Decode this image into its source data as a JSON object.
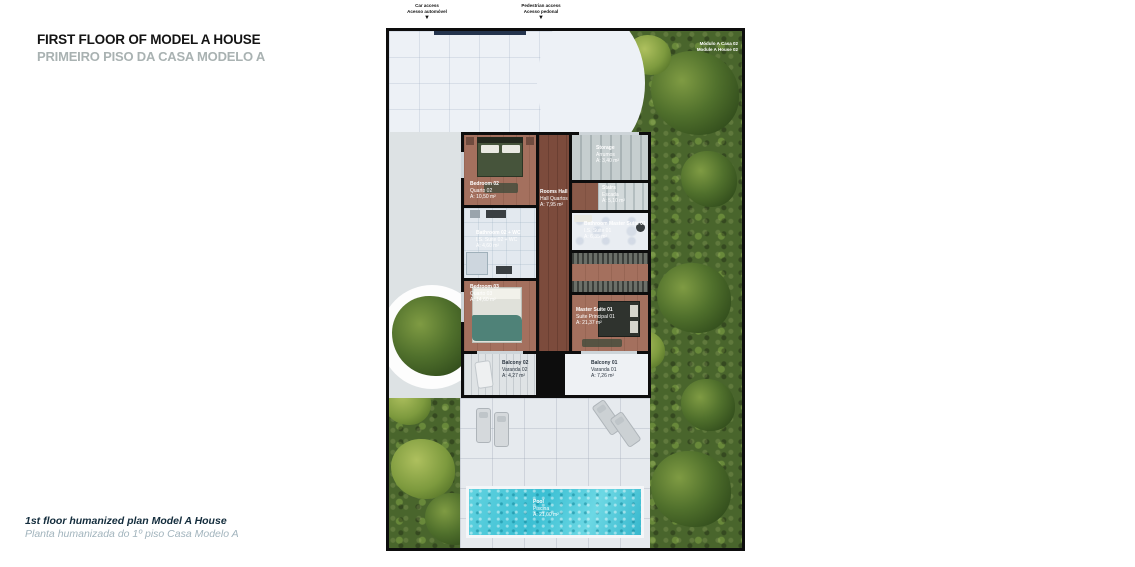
{
  "header": {
    "title_en": "FIRST FLOOR OF MODEL A HOUSE",
    "title_pt": "PRIMEIRO PISO DA CASA MODELO A"
  },
  "footer": {
    "caption_en": "1st floor humanized plan Model A House",
    "caption_pt": "Planta humanizada do 1º piso Casa Modelo A"
  },
  "access": {
    "car": {
      "en": "Car access",
      "pt": "Acesso automóvel",
      "arrow": "▼"
    },
    "pedestrian": {
      "en": "Pedestrian access",
      "pt": "Acesso pedonal",
      "arrow": "▼"
    }
  },
  "plan": {
    "module_label": {
      "pt": "Módulo A Casa 02",
      "en": "Module A House 02"
    },
    "rooms": {
      "bedroom02": {
        "en": "Bedroom 02",
        "pt": "Quarto 02",
        "area": "A: 10,50 m²"
      },
      "bathroom02": {
        "en": "Bathroom 02 + WC",
        "pt": "I.S. Suite 02 + WC",
        "area": "A: 4,60 m²"
      },
      "bedroom03": {
        "en": "Bedroom 03",
        "pt": "Quarto 03",
        "area": "A: 14,60 m²"
      },
      "hall": {
        "en": "Rooms Hall",
        "pt": "Hall Quartos",
        "area": "A: 7,95 m²"
      },
      "storage": {
        "en": "Storage",
        "pt": "Arrumos",
        "area": "A: 3,40 m²"
      },
      "stairs": {
        "en": "Stairs",
        "pt": "Escada",
        "area": "A: 5,10 m²"
      },
      "bathroom_master": {
        "en": "Bathroom Master Suite 01",
        "pt": "I.S. Suite 01",
        "area": "A: 6,35 m²"
      },
      "master_suite": {
        "en": "Master Suite 01",
        "pt": "Suite Principal 01",
        "area": "A: 21,37 m²"
      },
      "balcony02": {
        "en": "Balcony 02",
        "pt": "Varanda 02",
        "area": "A: 4,27 m²"
      },
      "balcony01": {
        "en": "Balcony 01",
        "pt": "Varanda 01",
        "area": "A: 7,26 m²"
      },
      "pool": {
        "en": "Pool",
        "pt": "Piscina",
        "area": "A: 21,00 m²"
      }
    },
    "colors": {
      "walls": "#0d0d0d",
      "garden": "#49652c",
      "driveway": "#edf1f6",
      "terrace": "#e6eaee",
      "wood": "#a4705e",
      "hall-wood": "#7c4b3c",
      "tile": "#e3e9ef",
      "pool": "#3fc0d4",
      "title-accent": "#a9b2b2"
    }
  }
}
